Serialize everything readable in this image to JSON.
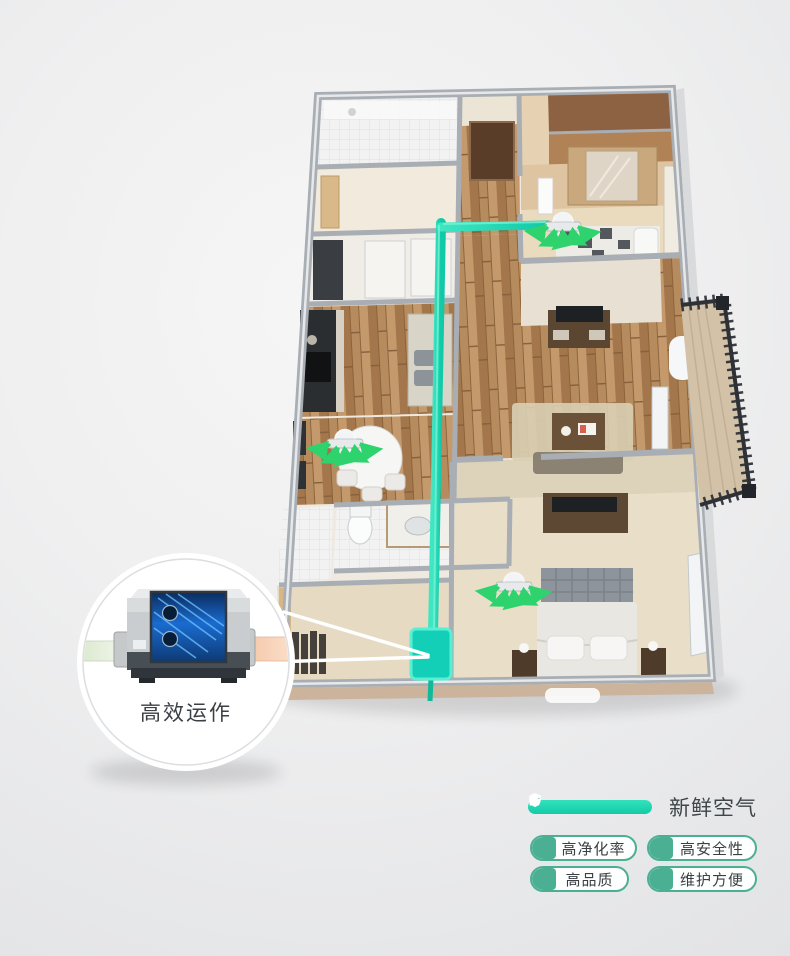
{
  "callout": {
    "label": "高效运作"
  },
  "legend": {
    "line_label": "新鲜空气",
    "badges": [
      {
        "icon": "leaf-icon",
        "label": "高净化率"
      },
      {
        "icon": "shield-icon",
        "label": "高安全性"
      },
      {
        "icon": "thumbs-up-icon",
        "label": "高品质"
      },
      {
        "icon": "pipe-icon",
        "label": "维护方便"
      }
    ]
  },
  "scene": {
    "diffusers": [
      "bedroom-2-diffuser",
      "dining-diffuser",
      "master-bedroom-diffuser"
    ],
    "ventilation_unit": "fresh-air-ventilation-unit",
    "callout_device": "heat-recovery-ventilator"
  },
  "colors": {
    "fresh_air_teal": "#17d6b1",
    "unit_teal": "#14cfb8",
    "arrow_green": "#2ed36d",
    "badge_green": "#4bb093",
    "text_dark": "#3b4044",
    "wall_gray": "#a8aeb4"
  }
}
